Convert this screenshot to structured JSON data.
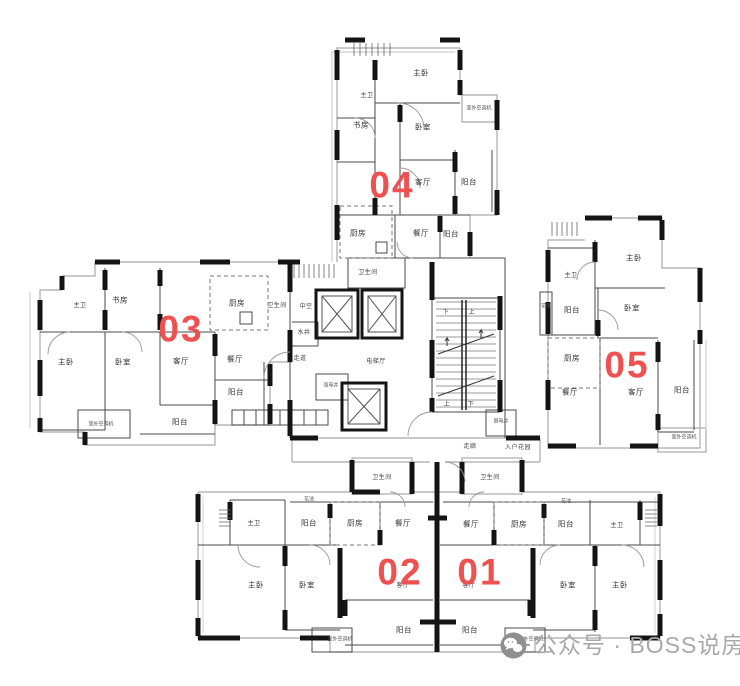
{
  "colors": {
    "unit_number": "#ef5050",
    "wall_black": "#141414",
    "partition_gray": "#4a4a4a",
    "outline_gray": "#a9a9a9",
    "label_text": "#333333",
    "watermark": "#a8a8a8",
    "background": "#ffffff"
  },
  "watermark": {
    "icon": "wechat-icon",
    "text": "公众号 · BOSS说房"
  },
  "plan": {
    "units": [
      {
        "id": "04",
        "x": 392,
        "y": 185
      },
      {
        "id": "03",
        "x": 181,
        "y": 329
      },
      {
        "id": "05",
        "x": 627,
        "y": 365
      },
      {
        "id": "02",
        "x": 400,
        "y": 572
      },
      {
        "id": "01",
        "x": 480,
        "y": 572
      }
    ],
    "labels": [
      {
        "unit": "04",
        "text": "主卧",
        "x": 421,
        "y": 73
      },
      {
        "unit": "04",
        "text": "主卫",
        "x": 367,
        "y": 96,
        "size": "md"
      },
      {
        "unit": "04",
        "text": "书房",
        "x": 361,
        "y": 125
      },
      {
        "unit": "04",
        "text": "卧室",
        "x": 423,
        "y": 127
      },
      {
        "unit": "04",
        "text": "室外空调机",
        "x": 479,
        "y": 109,
        "size": "sm"
      },
      {
        "unit": "04",
        "text": "客厅",
        "x": 423,
        "y": 182
      },
      {
        "unit": "04",
        "text": "阳台",
        "x": 469,
        "y": 182
      },
      {
        "unit": "04",
        "text": "厨房",
        "x": 358,
        "y": 233
      },
      {
        "unit": "04",
        "text": "餐厅",
        "x": 421,
        "y": 233
      },
      {
        "unit": "04",
        "text": "阳台",
        "x": 451,
        "y": 234
      },
      {
        "unit": "04",
        "text": "卫生间",
        "x": 368,
        "y": 273,
        "size": "md"
      },
      {
        "unit": "03",
        "text": "主卫",
        "x": 80,
        "y": 306,
        "size": "md"
      },
      {
        "unit": "03",
        "text": "书房",
        "x": 120,
        "y": 300
      },
      {
        "unit": "03",
        "text": "厨房",
        "x": 237,
        "y": 303
      },
      {
        "unit": "03",
        "text": "卫生间",
        "x": 277,
        "y": 306,
        "size": "md"
      },
      {
        "unit": "03",
        "text": "主卧",
        "x": 66,
        "y": 362
      },
      {
        "unit": "03",
        "text": "卧室",
        "x": 123,
        "y": 362
      },
      {
        "unit": "03",
        "text": "客厅",
        "x": 181,
        "y": 361
      },
      {
        "unit": "03",
        "text": "餐厅",
        "x": 235,
        "y": 359
      },
      {
        "unit": "03",
        "text": "阳台",
        "x": 236,
        "y": 392
      },
      {
        "unit": "03",
        "text": "阳台",
        "x": 180,
        "y": 422
      },
      {
        "unit": "03",
        "text": "室外空调机",
        "x": 101,
        "y": 425,
        "size": "sm"
      },
      {
        "unit": "core",
        "text": "中空",
        "x": 306,
        "y": 307,
        "size": "md"
      },
      {
        "unit": "core",
        "text": "水井",
        "x": 304,
        "y": 333,
        "size": "md"
      },
      {
        "unit": "core",
        "text": "走道",
        "x": 300,
        "y": 359,
        "size": "md"
      },
      {
        "unit": "core",
        "text": "电梯厅",
        "x": 376,
        "y": 362,
        "size": "md"
      },
      {
        "unit": "core",
        "text": "强电井",
        "x": 331,
        "y": 386,
        "size": "sm"
      },
      {
        "unit": "core",
        "text": "弱电井",
        "x": 501,
        "y": 422,
        "size": "sm"
      },
      {
        "unit": "core",
        "text": "走廊",
        "x": 470,
        "y": 447,
        "size": "md"
      },
      {
        "unit": "core",
        "text": "入户花园",
        "x": 518,
        "y": 448,
        "size": "md"
      },
      {
        "unit": "01",
        "text": "卫生间",
        "x": 490,
        "y": 478,
        "size": "md"
      },
      {
        "unit": "05",
        "text": "主卧",
        "x": 634,
        "y": 258
      },
      {
        "unit": "05",
        "text": "主卫",
        "x": 571,
        "y": 276,
        "size": "md"
      },
      {
        "unit": "05",
        "text": "花池",
        "x": 546,
        "y": 307,
        "size": "sm"
      },
      {
        "unit": "05",
        "text": "阳台",
        "x": 572,
        "y": 310
      },
      {
        "unit": "05",
        "text": "卧室",
        "x": 632,
        "y": 308
      },
      {
        "unit": "05",
        "text": "厨房",
        "x": 572,
        "y": 358
      },
      {
        "unit": "05",
        "text": "餐厅",
        "x": 570,
        "y": 392
      },
      {
        "unit": "05",
        "text": "客厅",
        "x": 636,
        "y": 392
      },
      {
        "unit": "05",
        "text": "阳台",
        "x": 682,
        "y": 390
      },
      {
        "unit": "05",
        "text": "室外空调机",
        "x": 684,
        "y": 438,
        "size": "sm"
      },
      {
        "unit": "02",
        "text": "卫生间",
        "x": 382,
        "y": 478,
        "size": "md"
      },
      {
        "unit": "02",
        "text": "花池",
        "x": 309,
        "y": 500,
        "size": "sm"
      },
      {
        "unit": "02",
        "text": "阳台",
        "x": 309,
        "y": 523
      },
      {
        "unit": "02",
        "text": "厨房",
        "x": 355,
        "y": 523
      },
      {
        "unit": "02",
        "text": "餐厅",
        "x": 403,
        "y": 523
      },
      {
        "unit": "02",
        "text": "主卫",
        "x": 254,
        "y": 524,
        "size": "md"
      },
      {
        "unit": "02",
        "text": "主卧",
        "x": 256,
        "y": 585
      },
      {
        "unit": "02",
        "text": "卧室",
        "x": 307,
        "y": 585
      },
      {
        "unit": "02",
        "text": "客厅",
        "x": 403,
        "y": 586,
        "size": "md"
      },
      {
        "unit": "02",
        "text": "阳台",
        "x": 404,
        "y": 630
      },
      {
        "unit": "02",
        "text": "室外空调机",
        "x": 340,
        "y": 640,
        "size": "sm"
      },
      {
        "unit": "01",
        "text": "餐厅",
        "x": 471,
        "y": 524
      },
      {
        "unit": "01",
        "text": "厨房",
        "x": 519,
        "y": 524
      },
      {
        "unit": "01",
        "text": "花池",
        "x": 566,
        "y": 502,
        "size": "sm"
      },
      {
        "unit": "01",
        "text": "阳台",
        "x": 566,
        "y": 524
      },
      {
        "unit": "01",
        "text": "主卫",
        "x": 617,
        "y": 526,
        "size": "md"
      },
      {
        "unit": "01",
        "text": "客厅",
        "x": 469,
        "y": 586,
        "size": "md"
      },
      {
        "unit": "01",
        "text": "卧室",
        "x": 568,
        "y": 585
      },
      {
        "unit": "01",
        "text": "主卧",
        "x": 620,
        "y": 585
      },
      {
        "unit": "01",
        "text": "阳台",
        "x": 470,
        "y": 630
      },
      {
        "unit": "01",
        "text": "室外空调机",
        "x": 531,
        "y": 640,
        "size": "sm"
      },
      {
        "unit": "stairs",
        "text": "下",
        "x": 446,
        "y": 313,
        "size": "md"
      },
      {
        "unit": "stairs",
        "text": "上",
        "x": 472,
        "y": 313,
        "size": "md"
      },
      {
        "unit": "stairs",
        "text": "上",
        "x": 447,
        "y": 405,
        "size": "md"
      },
      {
        "unit": "stairs",
        "text": "下",
        "x": 471,
        "y": 405,
        "size": "md"
      }
    ]
  }
}
